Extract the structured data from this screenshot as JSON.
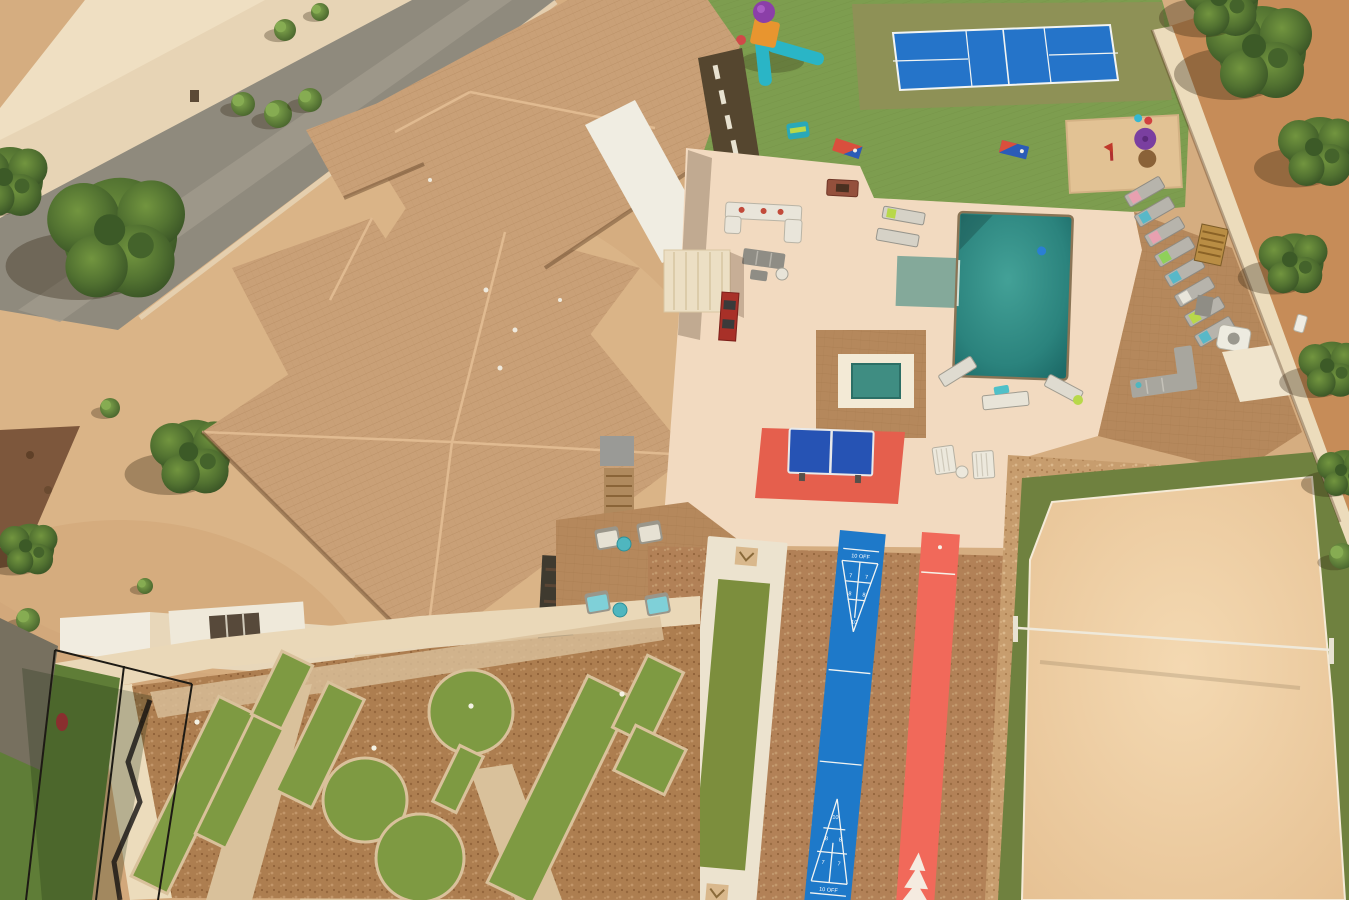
{
  "scene": {
    "type": "aerial-photograph",
    "description": "Drone aerial view of a desert estate: large tile-roof house beside a street, backyard resort amenities including pickleball court, playground, cornhole, tetherball sand pit, swimming pool with spa and tanning ledge, rows of lounge chairs, outdoor sofas and fire pit, ping-pong table, bocce lane, blue and red shuffleboard courts, sand volleyball court, mini-golf putting course and a batting cage."
  },
  "palette": {
    "desert": "#d5ad80",
    "road": "#8f8a7d",
    "roof": "#c9a077",
    "flat_roof": "#f0ede2",
    "deck": "#f2dac0",
    "pavers": "#b5885c",
    "turf": "#7d9d4f",
    "court_blue": "#2574c9",
    "pool": "#2f8d86",
    "shuffleboard_blue": "#1e79c9",
    "shuffleboard_red": "#f1695a",
    "sand": "#eecda4",
    "tree": "#4c6a2e",
    "wall": "#ecdcbc"
  },
  "shuffleboard": {
    "zones": [
      "10",
      "8",
      "7",
      "10 OFF"
    ]
  },
  "features": [
    "road",
    "driveway",
    "desert-yard",
    "main-house-roof",
    "flat-roof",
    "clerestory-windows",
    "playground",
    "lawn-turf",
    "pickleball-court",
    "tetherball-sand-pit",
    "cornhole-boards",
    "patio-sofas",
    "fire-pit",
    "pergola",
    "outdoor-kitchen",
    "swimming-pool",
    "tanning-ledge",
    "spa",
    "lounge-chairs",
    "outdoor-sectional",
    "ping-pong-table",
    "adirondack-chairs",
    "bocce-lane",
    "shuffleboard-court-blue",
    "shuffleboard-court-red",
    "sand-volleyball-court",
    "mini-golf-course",
    "batting-cage",
    "perimeter-wall",
    "trees"
  ]
}
